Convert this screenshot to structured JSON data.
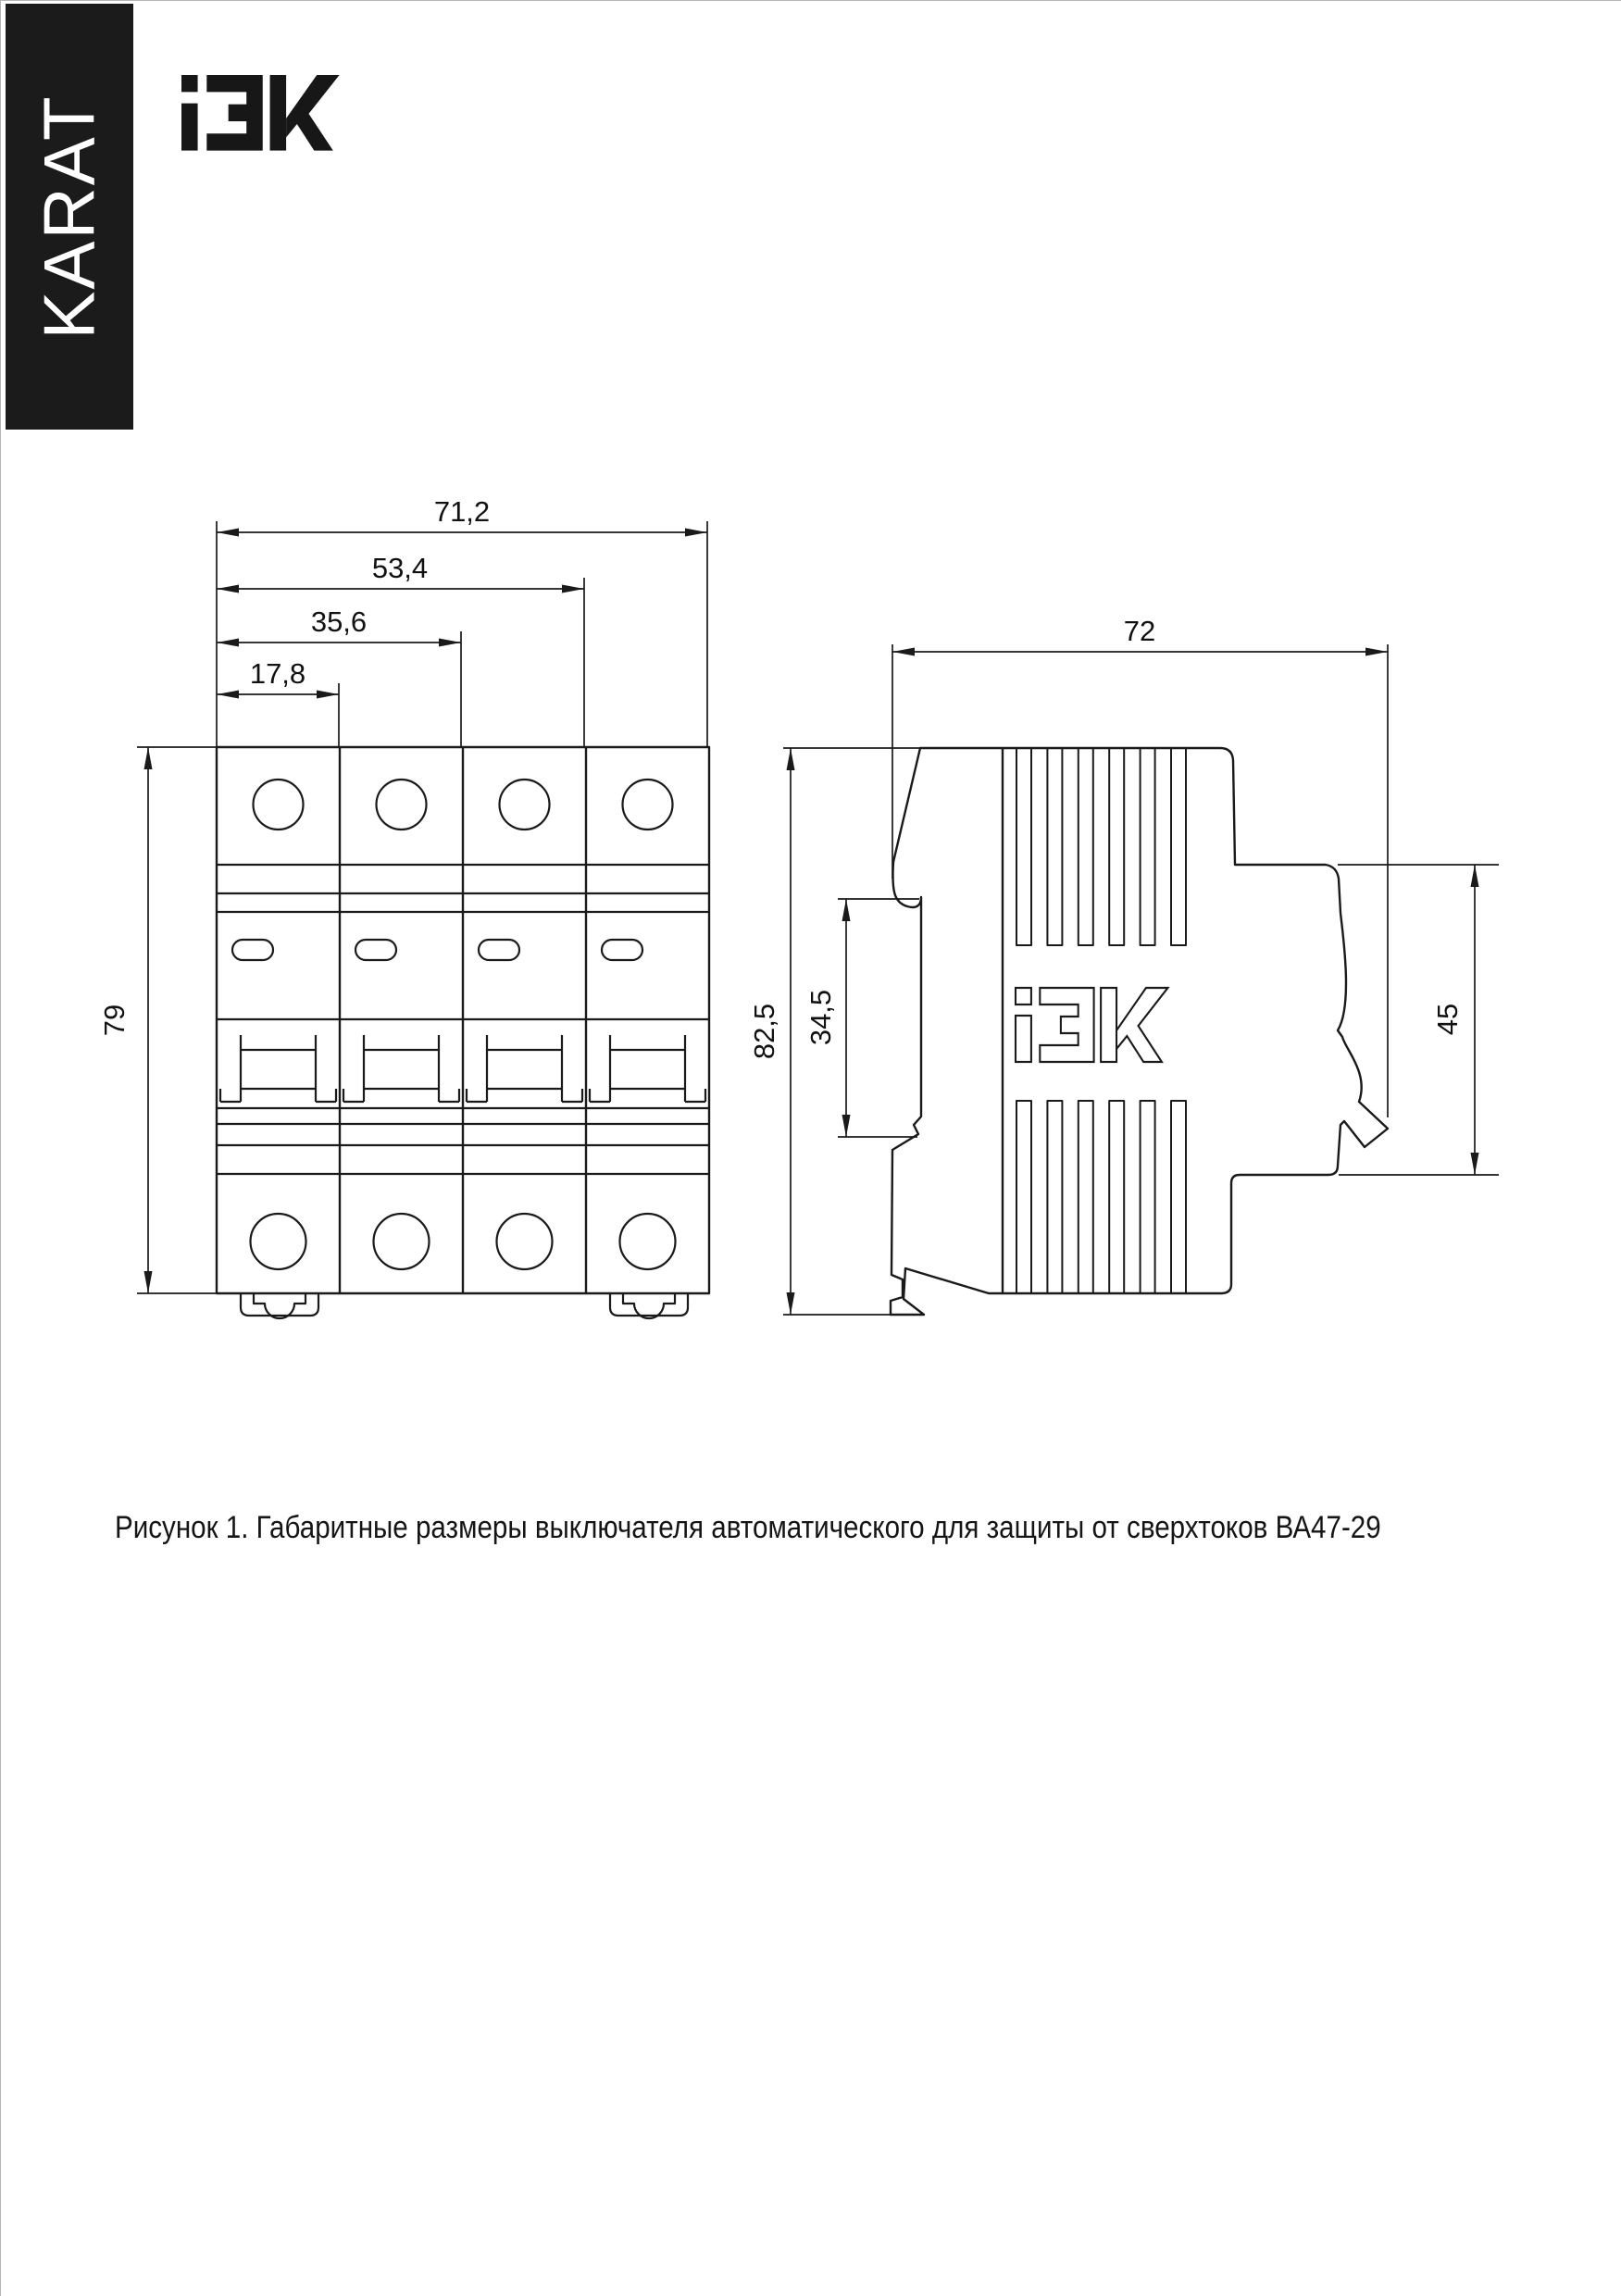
{
  "banner": {
    "text": "KARAT"
  },
  "header": {
    "logo": "IEK"
  },
  "drawing": {
    "front_view": {
      "dim_total_width": "71,2",
      "dim_width_three_modules": "53,4",
      "dim_width_two_modules": "35,6",
      "dim_module_width": "17,8",
      "dim_height": "79"
    },
    "side_view": {
      "dim_depth": "72",
      "dim_height": "82,5",
      "dim_din_recess_height": "34,5",
      "dim_terminal_recess_height": "45"
    }
  },
  "caption": {
    "text": "Рисунок 1. Габаритные размеры выключателя автоматического для защиты от сверхтоков ВА47-29"
  },
  "colors": {
    "line": "#1a1a1a",
    "banner_bg": "#1b1b1b",
    "text": "#111111",
    "page_bg": "#ffffff"
  }
}
